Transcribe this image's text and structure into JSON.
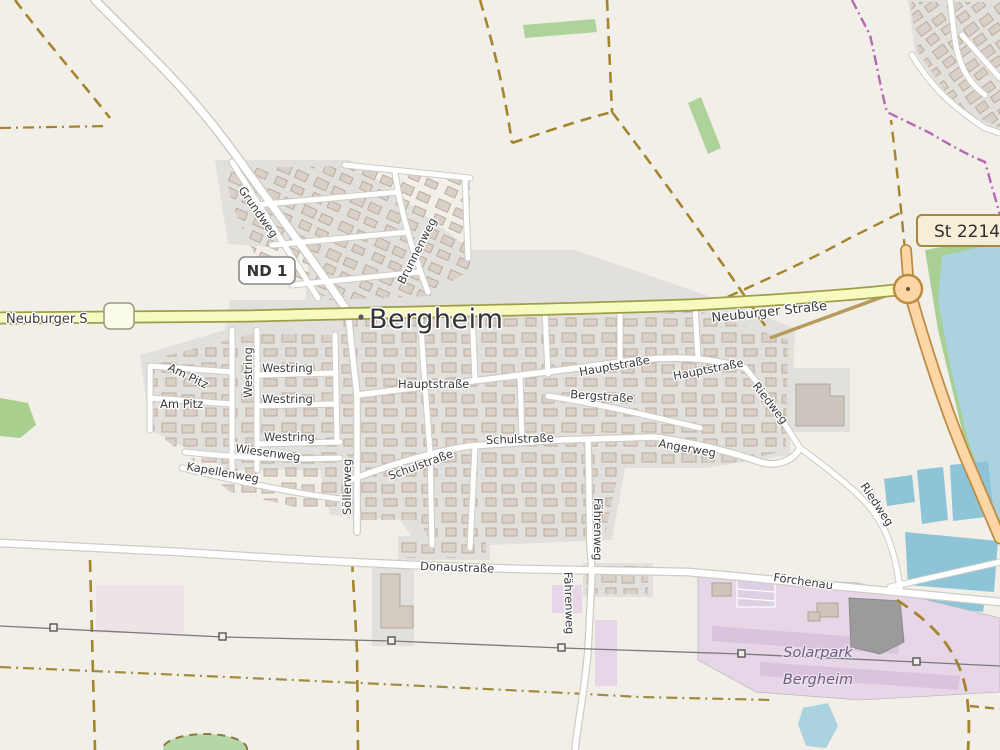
{
  "map": {
    "place_label": "Bergheim",
    "badges": {
      "nd1": "ND 1",
      "st2214": "St 2214"
    },
    "roads": {
      "neuburger_short": "Neuburger S",
      "neuburger": "Neuburger Straße",
      "hauptstrasse": "Hauptstraße",
      "bergstrasse": "Bergstraße",
      "schulstrasse": "Schulstraße",
      "angerweg": "Angerweg",
      "riedweg": "Riedweg",
      "westring": "Westring",
      "am_pitz": "Am Pitz",
      "wiesenweg": "Wiesenweg",
      "kapellenweg": "Kapellenweg",
      "soellerweg": "Söllerweg",
      "grundweg": "Grundweg",
      "brunnenweg": "Brunnenweg",
      "faehrenweg": "Fährenweg",
      "donaustrasse": "Donaustraße",
      "foerchenau": "Förchenau"
    },
    "areas": {
      "solarpark_line1": "Solarpark",
      "solarpark_line2": "Bergheim"
    },
    "colors": {
      "background": "#f2efe9",
      "residential": "#e2e0dd",
      "building": "#d9d0c9",
      "road_secondary": "#f7fabf",
      "road_primary": "#fcd6a4",
      "water": "#aad3df",
      "basin": "#8ec4d8",
      "green": "#aed39a",
      "solar_area": "#e6d6e8",
      "boundary": "#b668b6",
      "track": "#a5842e"
    }
  }
}
